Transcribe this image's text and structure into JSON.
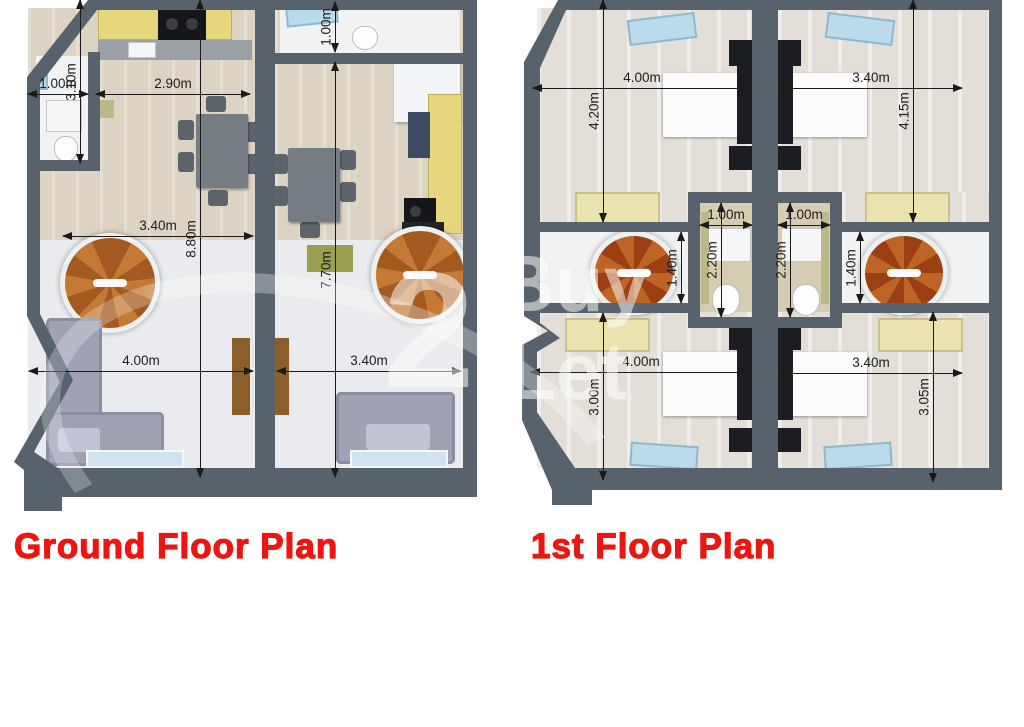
{
  "titles": {
    "ground": "Ground Floor Plan",
    "first": "1st Floor Plan"
  },
  "watermark": {
    "digit": "2",
    "line1": "Buy",
    "line2": "Let"
  },
  "ground_floor": {
    "dims": {
      "bath_width": "1.00m",
      "kitchen_width": "2.90m",
      "bath_depth": "3.10m",
      "wc_depth": "1.00m",
      "living_width": "3.40m",
      "unit_left_depth": "8.80m",
      "unit_right_depth": "7.70m",
      "lounge_left_width": "4.00m",
      "lounge_right_width": "3.40m"
    }
  },
  "first_floor": {
    "dims": {
      "bed_top_left_width": "4.00m",
      "bed_top_left_depth": "4.20m",
      "bed_top_right_width": "3.40m",
      "bed_top_right_depth": "4.15m",
      "bath_left_width": "1.00m",
      "bath_left_depth": "2.20m",
      "bath_right_width": "1.00m",
      "bath_right_depth": "2.20m",
      "landing_left_depth": "1.40m",
      "landing_right_depth": "1.40m",
      "bed_bottom_left_width": "4.00m",
      "bed_bottom_left_depth": "3.00m",
      "bed_bottom_right_width": "3.40m",
      "bed_bottom_right_depth": "3.05m"
    }
  },
  "colors": {
    "wall": "#57626c",
    "title_red": "#ee1511",
    "floor_wood": "#dcd3c3",
    "floor_light": "#e9ebee",
    "stair_wood": "#b0611f",
    "cabinet_yellow": "#e6d67c",
    "sofa_gray": "#a0a2b4",
    "skylight_blue": "#b9dbeb",
    "bed_frame_black": "#1b1d22"
  }
}
